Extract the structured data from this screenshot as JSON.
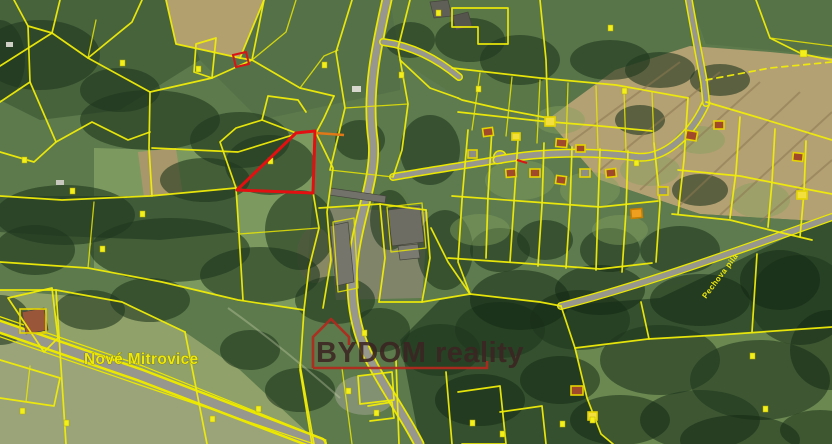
{
  "map": {
    "place_labels": {
      "settlement": {
        "text": "Nové Mitrovice"
      },
      "locality": {
        "text": "Pechova pila"
      }
    },
    "watermark": {
      "text": "BYDOM reality"
    },
    "colors": {
      "parcel_line": "#f0ec08",
      "highlighted_parcel": "#e21010",
      "secondary_highlight": "#e07818",
      "building_symbol_fill": "#f3df3e",
      "building_symbol_outline": "#df9700",
      "road_fill": "#97978e",
      "label_text": "#efe90a",
      "watermark_text": "#3c2422",
      "watermark_graphic": "#b3281e",
      "field_green": "#5c7a4b",
      "field_tan": "#b4a173",
      "forest_green": "#34502e"
    }
  }
}
